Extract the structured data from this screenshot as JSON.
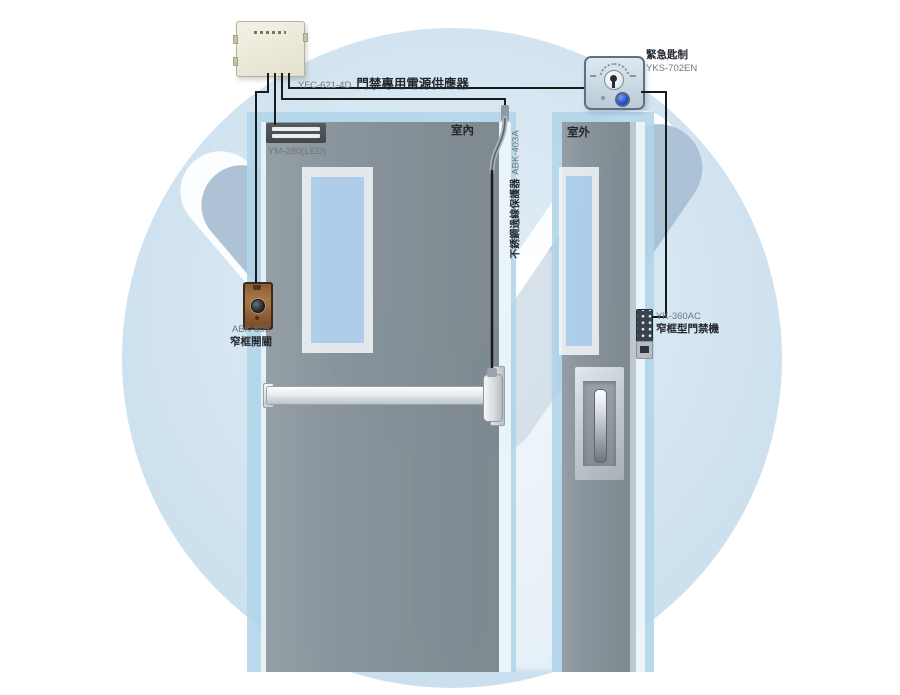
{
  "diagram": {
    "type": "access-control-installation-diagram",
    "colors": {
      "wall_blue": "#b1d4e7",
      "door_gray": "#848d94",
      "watermark_blue": "#a9bfd3",
      "wire_black": "#1a1a1a",
      "button_blue": "#1e4fd0",
      "exit_button_brown": "#96663c",
      "label_dark": "#23272d",
      "label_gray": "#70767c"
    }
  },
  "labels": {
    "power_supply": {
      "model": "YFC-621-4D",
      "name": "門禁專用電源供應器"
    },
    "maglock": {
      "model": "YM-280(LED)"
    },
    "room_inside": "室內",
    "room_outside": "室外",
    "conduit": {
      "name": "不銹鋼過線保護器",
      "model": "ABK-403A"
    },
    "exit_button": {
      "model": "ABK-805",
      "name": "窄框開關"
    },
    "emergency_switch": {
      "name": "緊急匙制",
      "model": "YKS-702EN"
    },
    "keypad": {
      "model": "YK-360AC",
      "name": "窄框型門禁機"
    }
  }
}
